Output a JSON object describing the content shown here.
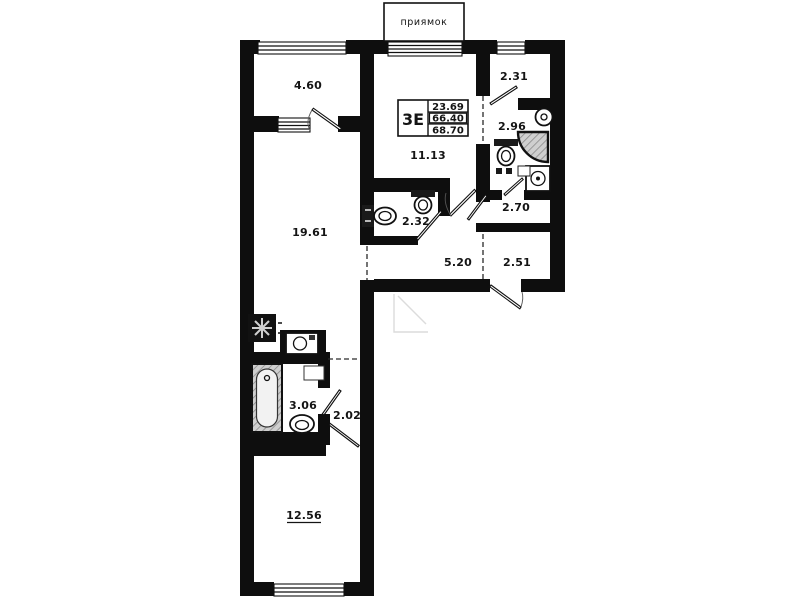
{
  "pit": {
    "label": "приямок"
  },
  "stamp": {
    "flat_type": "3Е",
    "living_area": "23.69",
    "area_main": "66.40",
    "area_total": "68.70"
  },
  "rooms": {
    "loggia": "4.60",
    "hall_upper": "2.31",
    "shower_room": "2.96",
    "kitchen_living": "11.13",
    "wc": "2.32",
    "wardrobe": "2.70",
    "corridor": "5.20",
    "entry": "2.51",
    "living_room": "19.61",
    "bathroom": "3.06",
    "hall_lower": "2.02",
    "bedroom": "12.56"
  }
}
